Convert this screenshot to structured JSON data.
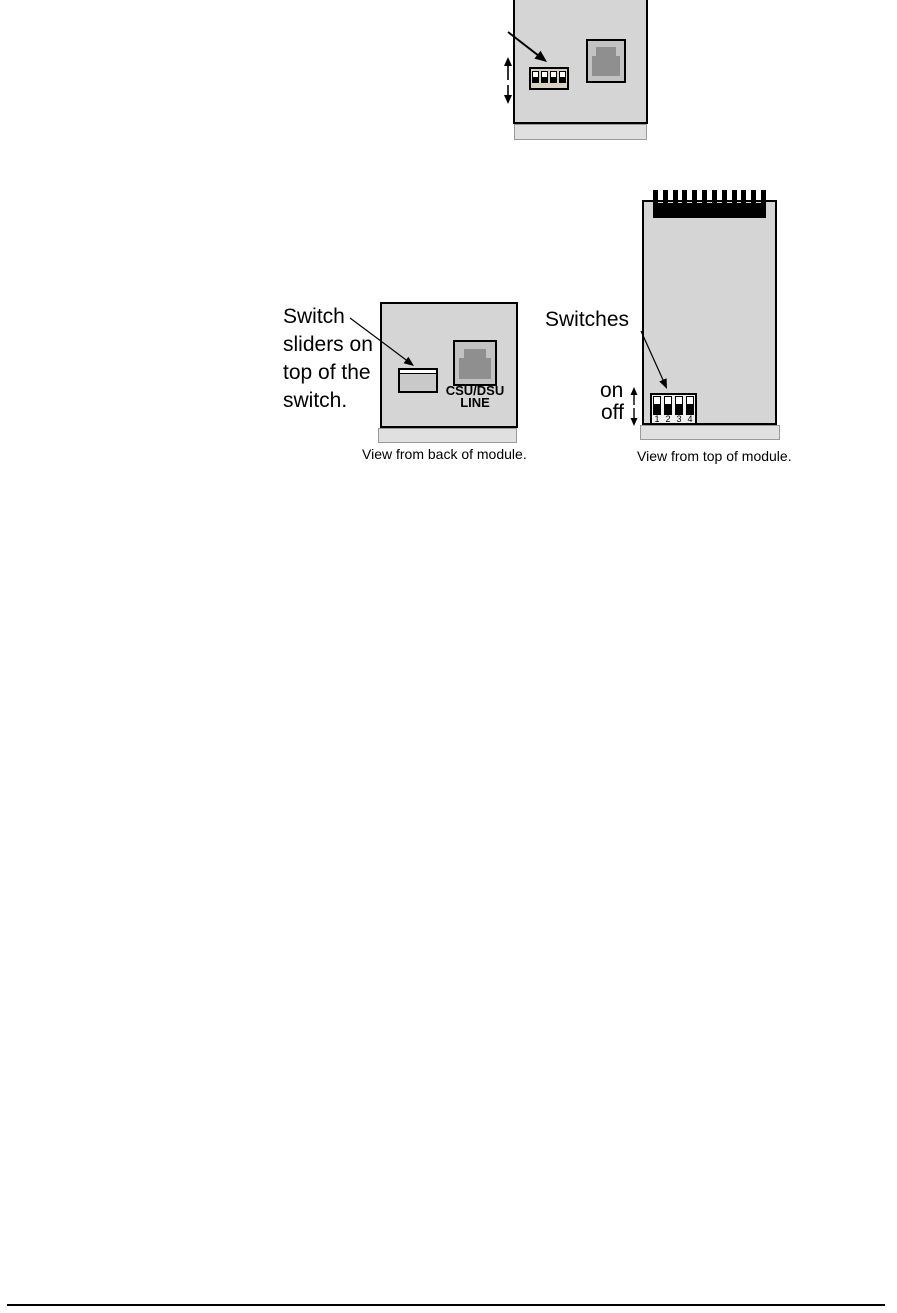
{
  "colors": {
    "module_panel": "#d5d5d5",
    "module_base_strip": "#e0e0e0",
    "jack_outer": "#c2c2c2",
    "jack_inner": "#8f8f8f",
    "dip_base_beige": "#d8d0c1",
    "dip_base_light": "#f0f0f0",
    "switch_back_gray": "#c9c9c9",
    "line_color": "#000000"
  },
  "figures": {
    "back_partial": {
      "dip_switch_states": [
        "up",
        "up",
        "up",
        "up"
      ]
    },
    "back_view": {
      "annotation_lines": [
        "Switch",
        "sliders on",
        "top of the",
        "switch."
      ],
      "port_label_line1": "CSU/DSU",
      "port_label_line2": "LINE",
      "caption": "View from back of module."
    },
    "top_view": {
      "annotation": "Switches",
      "on_label": "on",
      "off_label": "off",
      "connector_teeth": 12,
      "switch_numbers": [
        "1",
        "2",
        "3",
        "4"
      ],
      "dip_switch_states": [
        "up",
        "up",
        "up",
        "up"
      ],
      "caption": "View from top of module."
    }
  }
}
